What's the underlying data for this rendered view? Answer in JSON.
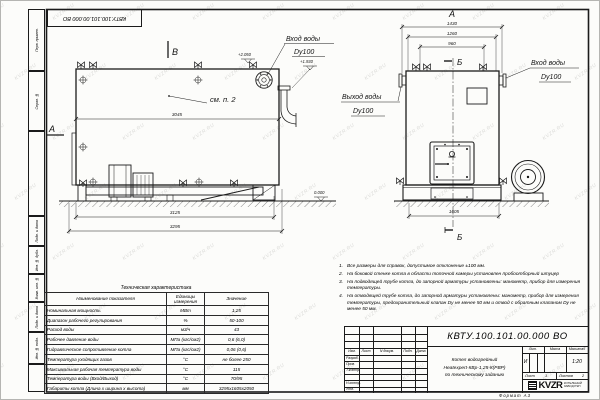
{
  "watermark": {
    "text": "KVZR.RU"
  },
  "frame": {
    "top_stamp": "КВТУ.100.101.00.000  ВО",
    "side_fields": [
      "Перв. примен.",
      "Справ. №",
      "Подп. и дата",
      "Инв. № дубл.",
      "Взам. инв. №",
      "Подп. и дата",
      "Инв. № подл."
    ],
    "format_note": "Формат   А3"
  },
  "side_view": {
    "view_label": "В",
    "section_label": "А",
    "callout": "см. п. 2",
    "dim_top": "3045",
    "dim_mid": "3125",
    "dim_full": "3295",
    "elev_inlet": "+2.050",
    "elev_outlet": "+1.930",
    "elev_zero": "0.000",
    "inlet_line1": "Вход воды",
    "inlet_line2": "Dy100"
  },
  "front_view": {
    "view_label": "А",
    "section_top": "Б",
    "section_bottom": "Б",
    "dim_outer": "1430",
    "dim_mid": "1260",
    "dim_inner": "960",
    "dim_base": "1605",
    "inlet_line1": "Вход воды",
    "inlet_line2": "Dy100",
    "outlet_line1": "Выход воды",
    "outlet_line2": "Dy100"
  },
  "spec_table": {
    "title": "Техническая характеристика",
    "headers": [
      "Наименование показателя",
      "Единицы измерения",
      "Значение"
    ],
    "rows": [
      [
        "Номинальная мощность",
        "МВт",
        "1,25"
      ],
      [
        "Диапазон рабочего регулирования",
        "%",
        "50-100"
      ],
      [
        "Расход воды",
        "м3/ч",
        "43"
      ],
      [
        "Рабочее давление воды",
        "МПа (кгс/см2)",
        "0,6 (6,0)"
      ],
      [
        "Гидравлическое сопротивление котла",
        "МПа (кгс/см2)",
        "0,06 (0,6)"
      ],
      [
        "Температура уходящих газов",
        "°С",
        "не более 250"
      ],
      [
        "Максимальная рабочая температура воды",
        "°С",
        "115"
      ],
      [
        "Температура воды (Вход/Выход)",
        "°С",
        "70/95"
      ],
      [
        "Габариты котла (Длина х ширина х высота)",
        "мм",
        "3295х1605х2050"
      ]
    ]
  },
  "notes": {
    "items": [
      {
        "num": "1.",
        "text": "Все размеры для справок, допустимое отклонение ±100 мм."
      },
      {
        "num": "2.",
        "text": "На боковой стенке котла в области топочной камеры установлен пробоотборный штуцер"
      },
      {
        "num": "3.",
        "text": "На  подводящей трубе котла, до запорной арматуры установлены: манометр, прибор для измерения температуры."
      },
      {
        "num": "4.",
        "text": "На отводящей трубе котла, до запорной арматуры установлены: манометр, прибор для измерения температуры, предохранительный клапан Dу не менее 50 мм и отвод с обратным клапаном Dу не менее 50 мм."
      }
    ]
  },
  "title_block": {
    "doc_number": "КВТУ.100.101.00.000  ВО",
    "header_cols": [
      "Изм.",
      "Лист",
      "N докум.",
      "Подп.",
      "Дата"
    ],
    "roles": [
      "Разраб.",
      "Пров.",
      "Т.контр.",
      "",
      "Н.контр.",
      "Утв."
    ],
    "product_line1": "Котел водогрейный",
    "product_line2": "Heatexpert-КВр-1,25-К(РВР)",
    "product_line3": "по техническому заданию",
    "lit_label": "Лит.",
    "lit_value": "И",
    "mass_label": "Масса",
    "scale_label": "Масштаб",
    "scale_value": "1:20",
    "sheet_label": "Лист",
    "sheet_value": "1",
    "sheets_label": "Листов",
    "sheets_value": "2",
    "logo_text": "KVZR",
    "company_line1": "КОТЕЛЬНЫЙ",
    "company_line2": "ЗАВОД РЭП"
  }
}
